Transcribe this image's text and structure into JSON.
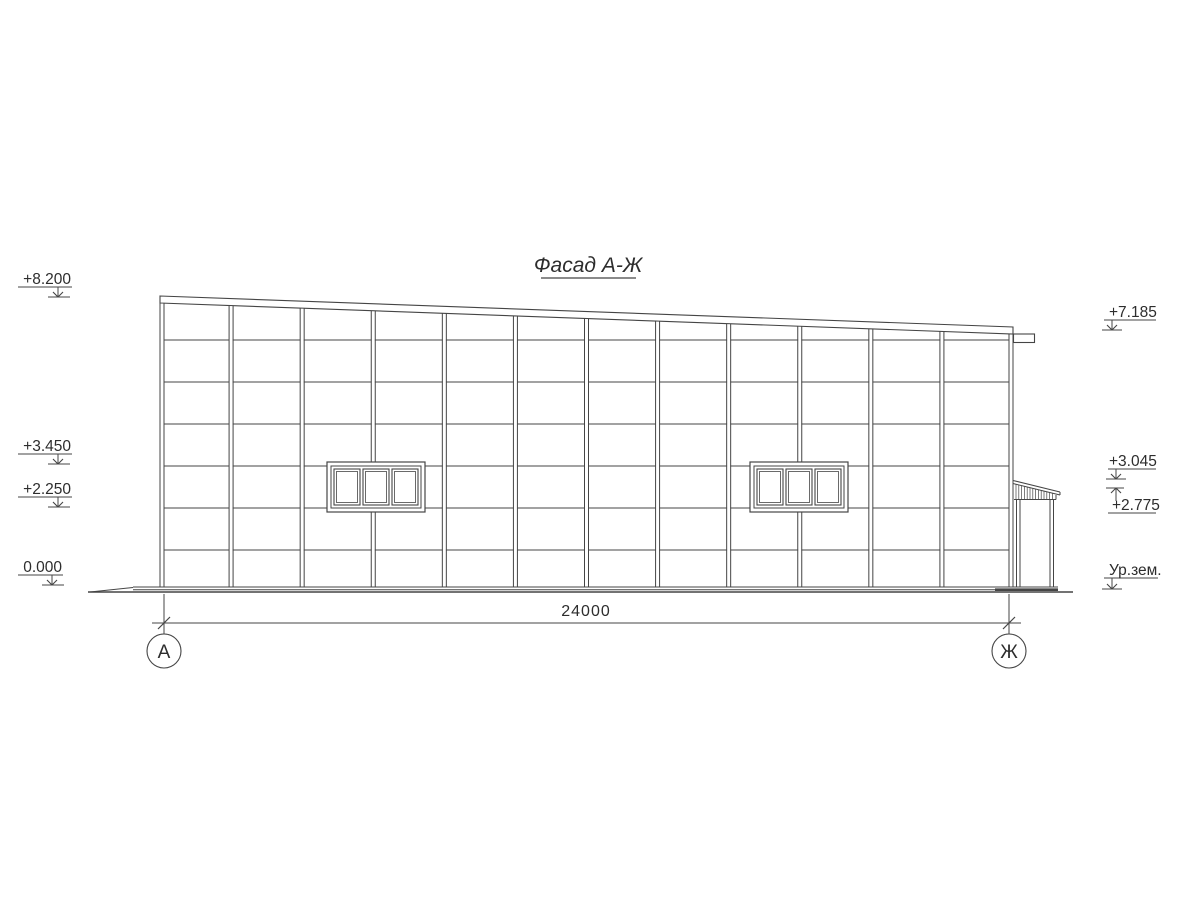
{
  "title": "Фасад А-Ж",
  "dimension": {
    "total_mm": "24000"
  },
  "axis_bubbles": {
    "left": "А",
    "right": "Ж"
  },
  "elevation_marks_left": [
    {
      "label": "+8.200"
    },
    {
      "label": "+3.450"
    },
    {
      "label": "+2.250"
    },
    {
      "label": "0.000"
    }
  ],
  "elevation_marks_right": [
    {
      "label": "+7.185"
    },
    {
      "label": "+3.045"
    },
    {
      "label": "+2.775"
    },
    {
      "label": "Ур.зем."
    }
  ],
  "facade": {
    "bays": 12,
    "grid_rows": 7,
    "window_groups": 2,
    "panes_per_window": 3
  },
  "colors": {
    "line": "#454545",
    "text": "#2d2d2d",
    "background": "#ffffff"
  }
}
